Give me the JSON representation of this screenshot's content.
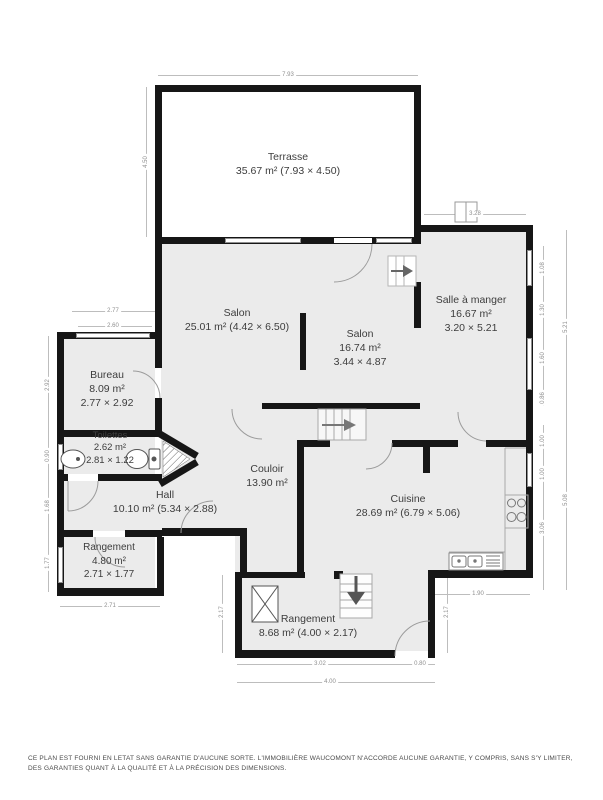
{
  "rooms": {
    "terrasse": {
      "name": "Terrasse",
      "line2": "35.67 m² (7.93 × 4.50)"
    },
    "salon1": {
      "name": "Salon",
      "line2": "25.01 m² (4.42 × 6.50)"
    },
    "salon2": {
      "name": "Salon",
      "line2": "16.74 m²",
      "line3": "3.44 × 4.87"
    },
    "salle_a_manger": {
      "name": "Salle à manger",
      "line2": "16.67 m²",
      "line3": "3.20 × 5.21"
    },
    "bureau": {
      "name": "Bureau",
      "line2": "8.09 m²",
      "line3": "2.77 × 2.92"
    },
    "toilettes": {
      "name": "Toilettes",
      "line2": "2.62 m²",
      "line3": "2.81 × 1.22"
    },
    "hall": {
      "name": "Hall",
      "line2": "10.10 m² (5.34 × 2.88)"
    },
    "rangement_gauche": {
      "name": "Rangement",
      "line2": "4.80 m²",
      "line3": "2.71 × 1.77"
    },
    "couloir": {
      "name": "Couloir",
      "line2": "13.90 m²"
    },
    "cuisine": {
      "name": "Cuisine",
      "line2": "28.69 m² (6.79 × 5.06)"
    },
    "rangement_bas": {
      "name": "Rangement",
      "line2": "8.68 m² (4.00 × 2.17)"
    }
  },
  "dimensions": {
    "terrasse_w": "7.93",
    "terrasse_h": "4.50",
    "salle_top": "3.28",
    "bureau_outer": "2.77",
    "bureau_inner": "2.60",
    "left_bureau": "2.92",
    "left_toilettes": "0.90",
    "left_hall": "1.68",
    "left_rangement": "1.77",
    "bottom_left": "2.71",
    "right_1": "1.08",
    "right_2": "1.30",
    "right_3": "1.60",
    "right_4": "0.86",
    "right_total_up": "5.21",
    "right_5": "1.00",
    "right_6": "1.00",
    "right_7": "3.06",
    "right_total_down": "5.08",
    "stair_clearance": "1.90",
    "rb_left": "2.17",
    "rb_right": "2.17",
    "rb_b1": "3.02",
    "rb_b2": "0.80",
    "rb_total": "4.00"
  },
  "colors": {
    "wall": "#161616",
    "room_fill": "#ebebeb",
    "dim": "#8f8f8f",
    "text": "#3d3d3d"
  },
  "footer": {
    "disclaimer": "CE PLAN EST FOURNI EN LETAT SANS GARANTIE D'AUCUNE SORTE. L'IMMOBILIÈRE WAUCOMONT N'ACCORDE AUCUNE GARANTIE, Y COMPRIS, SANS S'Y LIMITER, DES GARANTIES QUANT À LA QUALITÉ ET À LA PRÉCISION DES DIMENSIONS."
  }
}
